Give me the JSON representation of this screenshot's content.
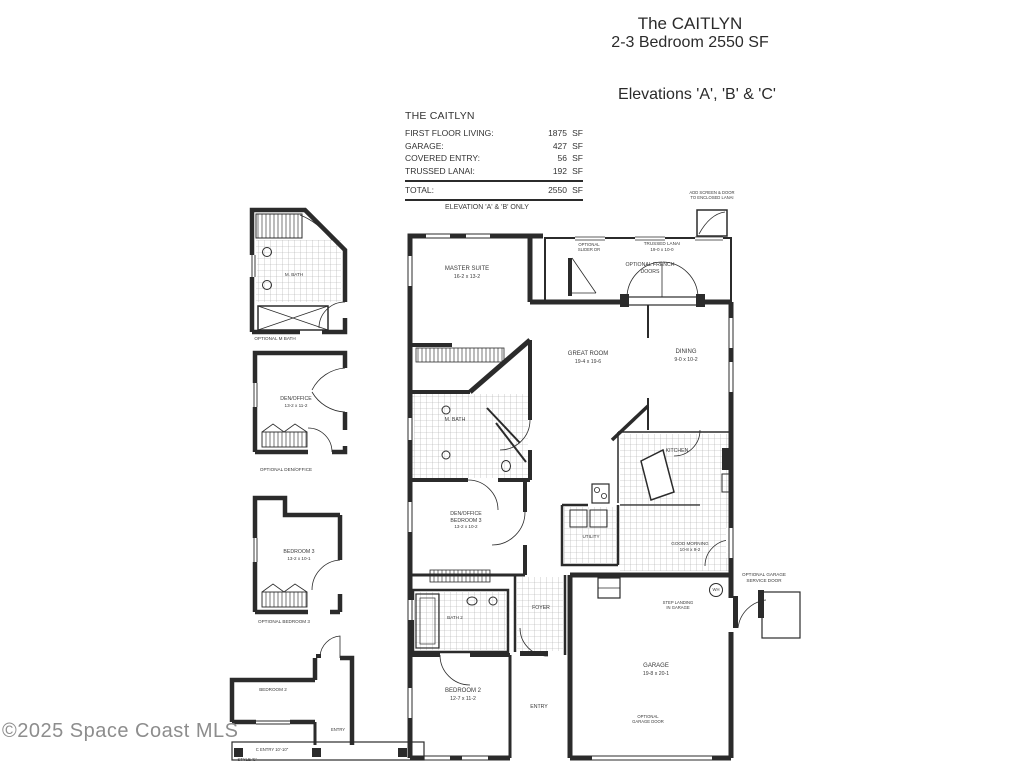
{
  "header": {
    "title": "The CAITLYN",
    "subtitle": "2-3 Bedroom 2550 SF",
    "elevations": "Elevations 'A', 'B' & 'C'"
  },
  "area_table": {
    "title": "THE CAITLYN",
    "rows": [
      {
        "label": "FIRST FLOOR LIVING:",
        "value": "1875",
        "unit": "SF"
      },
      {
        "label": "GARAGE:",
        "value": "427",
        "unit": "SF"
      },
      {
        "label": "COVERED ENTRY:",
        "value": "56",
        "unit": "SF"
      },
      {
        "label": "TRUSSED LANAI:",
        "value": "192",
        "unit": "SF"
      }
    ],
    "total": {
      "label": "TOTAL:",
      "value": "2550",
      "unit": "SF"
    }
  },
  "main_plan": {
    "elevation_note": "ELEVATION 'A' & 'B' ONLY",
    "screen_note_line1": "ADD SCREEN & DOOR",
    "screen_note_line2": "TO ENCLOSED LANAI",
    "rooms": {
      "trussed_lanai": {
        "name": "TRUSSED LANAI",
        "dims": "19-0 x 10-0"
      },
      "optional_slider": {
        "line1": "OPTIONAL",
        "line2": "SLIDER DR"
      },
      "french_doors": {
        "line1": "OPTIONAL FRENCH",
        "line2": "DOORS"
      },
      "master_suite": {
        "name": "MASTER SUITE",
        "dims": "16-2 x 13-2"
      },
      "great_room": {
        "name": "GREAT ROOM",
        "dims": "19-4 x 19-6"
      },
      "dining": {
        "name": "DINING",
        "dims": "9-0 x 10-2"
      },
      "m_bath": {
        "name": "M. BATH"
      },
      "kitchen": {
        "name": "KITCHEN"
      },
      "good_morning": {
        "name": "GOOD MORNING",
        "dims": "10-8 x 9-2"
      },
      "utility": {
        "name": "UTILITY"
      },
      "den_office": {
        "line1": "DEN/OFFICE",
        "line2": "BEDROOM 3",
        "dims": "13-2 x 10-2"
      },
      "foyer": {
        "name": "FOYER"
      },
      "bath_2": {
        "name": "BATH 2"
      },
      "bedroom_2": {
        "name": "BEDROOM 2",
        "dims": "12-7 x 11-2"
      },
      "entry": {
        "name": "ENTRY"
      },
      "garage": {
        "name": "GARAGE",
        "dims": "19-8 x 20-1"
      },
      "opt_garage_door": {
        "line1": "OPTIONAL",
        "line2": "GARAGE DOOR"
      },
      "step_note": {
        "line1": "STEP LANDING",
        "line2": "IN GARAGE"
      },
      "service_door": {
        "line1": "OPTIONAL GARAGE",
        "line2": "SERVICE DOOR"
      },
      "water_heater": "WH"
    }
  },
  "insets": {
    "m_bath": {
      "inner": "M. BATH",
      "caption": "OPTIONAL M BATH"
    },
    "den_office": {
      "name": "DEN/OFFICE",
      "dims": "13-2 x 11-2",
      "caption": "OPTIONAL DEN/OFFICE"
    },
    "bedroom_3": {
      "name": "BEDROOM 3",
      "dims": "13-2 x 10-1",
      "caption": "OPTIONAL BEDROOM 3"
    },
    "style_c": {
      "bedroom": "BEDROOM 2",
      "entry": "ENTRY",
      "dim": "C ENTRY 10'-10\"",
      "style": "STYLE 'C'"
    }
  },
  "watermark": "©2025 Space Coast MLS",
  "colors": {
    "line": "#2b2b2b",
    "thin_line": "#4a4a4a",
    "tile": "#9a9a9a",
    "watermark": "#8d8d8d",
    "background": "#ffffff"
  }
}
